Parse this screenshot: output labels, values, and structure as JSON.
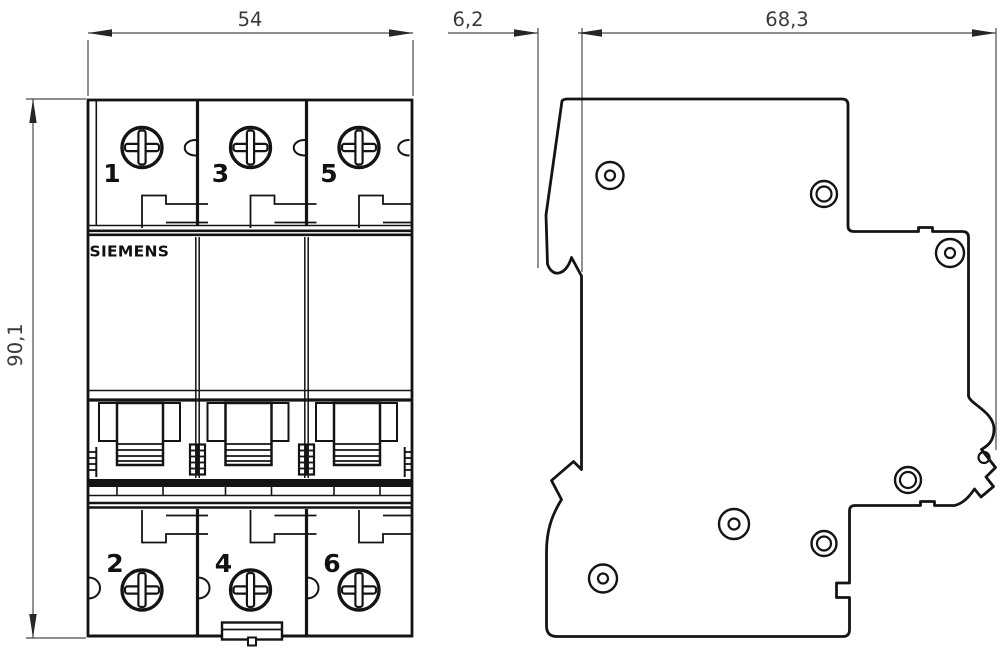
{
  "drawing": {
    "title": "Siemens miniature circuit breaker 3-pole dimensional drawing",
    "brand": "SIEMENS",
    "dimensions": {
      "front_width": "54",
      "front_height": "90,1",
      "side_front_depth": "6,2",
      "side_body_depth": "68,3"
    },
    "front_view": {
      "poles": [
        {
          "top_terminal": "1",
          "bottom_terminal": "2"
        },
        {
          "top_terminal": "3",
          "bottom_terminal": "4"
        },
        {
          "top_terminal": "5",
          "bottom_terminal": "6"
        }
      ]
    },
    "colors": {
      "line": "#141414",
      "dimension_line": "#4a4a4a",
      "text": "#3a3a3a",
      "background": "#ffffff"
    }
  }
}
